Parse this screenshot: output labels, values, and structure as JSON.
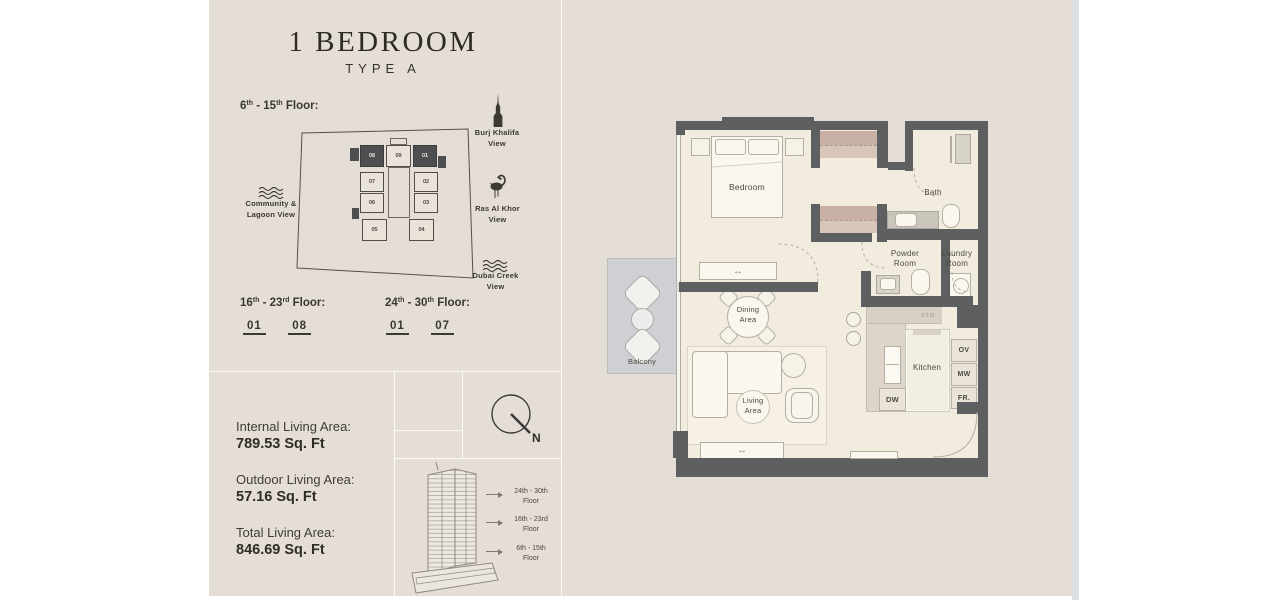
{
  "header": {
    "title": "1 BEDROOM",
    "subtitle": "TYPE A"
  },
  "key_plan": {
    "heading": {
      "n1": "6",
      "s1": "th",
      "sep": "-",
      "n2": "15",
      "s2": "th",
      "tail": "Floor:"
    },
    "units": [
      {
        "label": "08",
        "dark": true
      },
      {
        "label": "09",
        "dark": false
      },
      {
        "label": "01",
        "dark": true
      },
      {
        "label": "07",
        "dark": false
      },
      {
        "label": "02",
        "dark": false
      },
      {
        "label": "06",
        "dark": false
      },
      {
        "label": "03",
        "dark": false
      },
      {
        "label": "05",
        "dark": false
      },
      {
        "label": "04",
        "dark": false
      }
    ],
    "views": {
      "burj": {
        "line1": "Burj Khalifa",
        "line2": "View"
      },
      "ras": {
        "line1": "Ras Al Khor",
        "line2": "View"
      },
      "creek": {
        "line1": "Dubai Creek",
        "line2": "View"
      },
      "community": {
        "line1": "Community &",
        "line2": "Lagoon View"
      }
    }
  },
  "floor_lists": [
    {
      "n1": "16",
      "s1": "th",
      "sep": "-",
      "n2": "23",
      "s2": "rd",
      "tail": "Floor:",
      "units": [
        {
          "label": "01"
        },
        {
          "label": "08"
        }
      ]
    },
    {
      "n1": "24",
      "s1": "th",
      "sep": "-",
      "n2": "30",
      "s2": "th",
      "tail": "Floor:",
      "units": [
        {
          "label": "01"
        },
        {
          "label": "07"
        }
      ]
    }
  ],
  "stats": [
    {
      "label": "Internal Living Area:",
      "value": "789.53 Sq. Ft"
    },
    {
      "label": "Outdoor Living Area:",
      "value": "57.16 Sq. Ft"
    },
    {
      "label": "Total Living Area:",
      "value": "846.69 Sq. Ft"
    }
  ],
  "compass": {
    "north": "N"
  },
  "elevation": {
    "labels": [
      {
        "range": "24th - 30th",
        "word": "Floor"
      },
      {
        "range": "16th - 23rd",
        "word": "Floor"
      },
      {
        "range": "6th - 15th",
        "word": "Floor"
      }
    ]
  },
  "plan": {
    "rooms": {
      "bedroom": "Bedroom",
      "bath": "Bath",
      "powder": {
        "line1": "Powder",
        "line2": "Room"
      },
      "laundry": {
        "line1": "Laundry",
        "line2": "Room"
      },
      "dining": {
        "line1": "Dining",
        "line2": "Area"
      },
      "living": {
        "line1": "Living",
        "line2": "Area"
      },
      "kitchen": "Kitchen",
      "balcony": "Balcony",
      "sto": "STO"
    },
    "appliances": [
      {
        "label": "OV"
      },
      {
        "label": "MW"
      },
      {
        "label": "FR."
      }
    ],
    "dw": "DW"
  },
  "colors": {
    "page_margin": "#ffffff",
    "panel_bg": "#e5ded7",
    "wall": "#5e5f61",
    "room_cream": "#f2ecdf",
    "closet_pink": "#c9b0a5",
    "balcony_gray": "#cfd0d3",
    "scrollbar": "#dde0e3",
    "text": "#3c3a36"
  }
}
